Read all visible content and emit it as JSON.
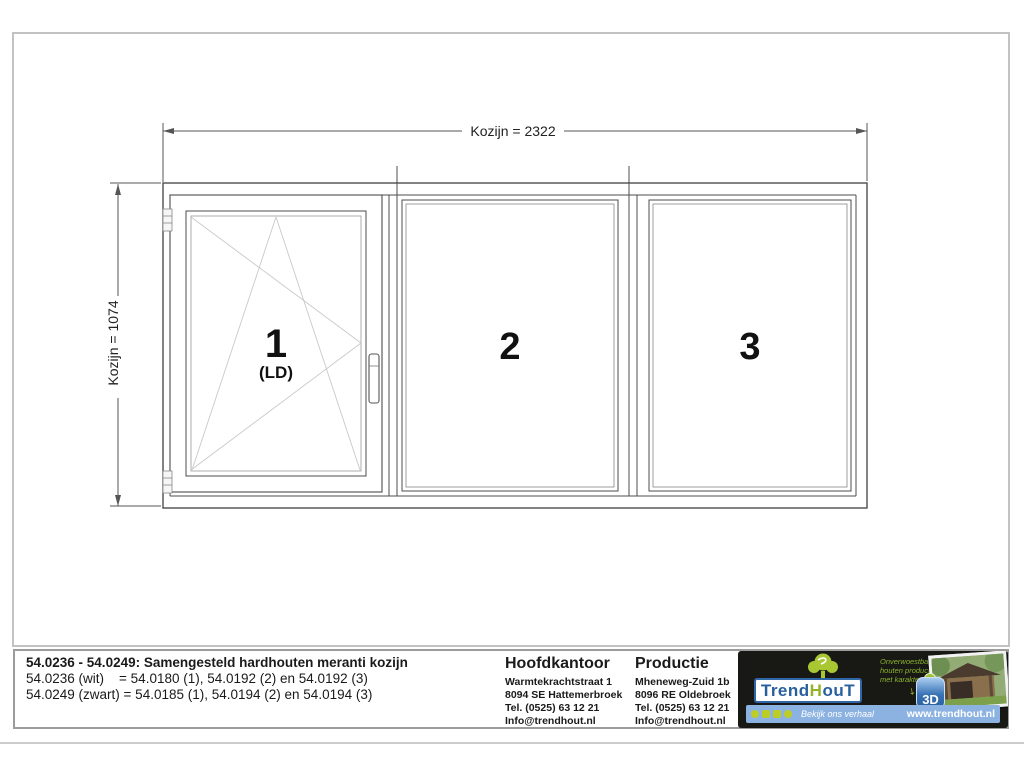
{
  "drawing": {
    "dim_width_label": "Kozijn = 2322",
    "dim_height_label": "Kozijn = 1074",
    "panels": [
      {
        "number": "1",
        "sub_label": "(LD)",
        "type": "tilt-turn opening window"
      },
      {
        "number": "2",
        "type": "fixed glazing"
      },
      {
        "number": "3",
        "type": "fixed glazing"
      }
    ]
  },
  "title_block": {
    "title": "54.0236 - 54.0249: Samengesteld hardhouten meranti kozijn",
    "line_wit": "54.0236 (wit)    = 54.0180 (1), 54.0192 (2) en 54.0192 (3)",
    "line_zwart": "54.0249 (zwart) = 54.0185 (1), 54.0194 (2) en 54.0194 (3)",
    "hoofdkantoor": {
      "heading": "Hoofdkantoor",
      "address1": "Warmtekrachtstraat 1",
      "address2": "8094 SE Hattemerbroek",
      "tel": "Tel. (0525) 63 12 21",
      "email": "Info@trendhout.nl"
    },
    "productie": {
      "heading": "Productie",
      "address1": "Mheneweg-Zuid 1b",
      "address2": "8096 RE Oldebroek",
      "tel": "Tel. (0525) 63 12 21",
      "email": "Info@trendhout.nl"
    },
    "logo": {
      "brand_part1": "Trend",
      "brand_part2": "H",
      "brand_part3": "ouT",
      "slogan": "Onverwoestbare\nhouten producten\nmet karakter",
      "badge_label": "3D",
      "strip_text": "Bekijk ons verhaal",
      "website": "www.trendhout.nl"
    },
    "colors": {
      "logo_blue": "#28609e",
      "logo_green": "#a9c733",
      "strip_blue": "#8cb2e2",
      "panel_black": "#181815"
    }
  }
}
